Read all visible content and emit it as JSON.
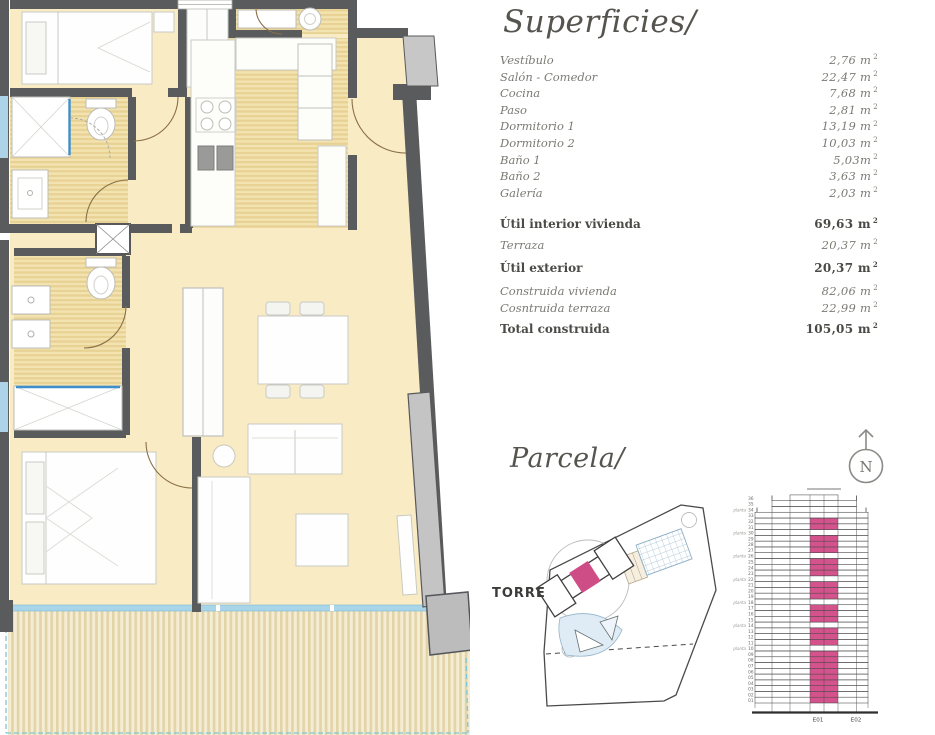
{
  "superficies": {
    "title": "Superficies/",
    "unit_sup": "2",
    "rows": [
      {
        "label": "Vestíbulo",
        "value": "2,76 m",
        "bold": false
      },
      {
        "label": "Salón - Comedor",
        "value": "22,47 m",
        "bold": false
      },
      {
        "label": "Cocina",
        "value": "7,68 m",
        "bold": false
      },
      {
        "label": "Paso",
        "value": "2,81 m",
        "bold": false
      },
      {
        "label": "Dormitorio 1",
        "value": "13,19 m",
        "bold": false
      },
      {
        "label": "Dormitorio 2",
        "value": "10,03 m",
        "bold": false
      },
      {
        "label": "Baño 1",
        "value": "5,03m",
        "bold": false
      },
      {
        "label": "Baño 2",
        "value": "3,63 m",
        "bold": false
      },
      {
        "label": "Galería",
        "value": "2,03 m",
        "bold": false
      },
      {
        "label": "Útil interior vivienda",
        "value": "69,63 m",
        "bold": true
      },
      {
        "label": "Terraza",
        "value": "20,37 m",
        "bold": false
      },
      {
        "label": "Útil exterior",
        "value": "20,37 m",
        "bold": true
      },
      {
        "label": "Construida vivienda",
        "value": "82,06 m",
        "bold": false
      },
      {
        "label": "Cosntruida terraza",
        "value": "22,99 m",
        "bold": false
      },
      {
        "label": "Total construida",
        "value": "105,05 m",
        "bold": true
      }
    ]
  },
  "parcela": {
    "title": "Parcela/",
    "site_label": "TORRE",
    "compass_label": "N",
    "highlight_color": "#cf4d87"
  },
  "tower": {
    "floors": 36,
    "pink_color": "#d4538c",
    "pink_floor_min": 1,
    "pink_floor_max": 32,
    "skip_floors": [
      10,
      14,
      18,
      22,
      26,
      30
    ],
    "side_label": "planta",
    "side_label_floors": [
      10,
      14,
      18,
      22,
      26,
      30,
      34
    ],
    "entrance_labels": [
      "E01",
      "E02"
    ]
  }
}
